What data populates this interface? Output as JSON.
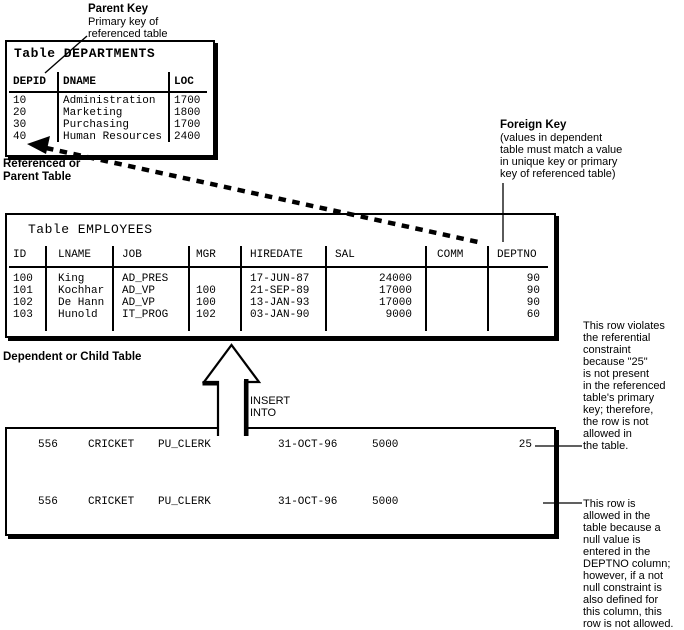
{
  "colors": {
    "ink": "#000000",
    "paper": "#ffffff"
  },
  "parent_key_note": {
    "title": "Parent Key",
    "line1": "Primary key of",
    "line2": "referenced table"
  },
  "referenced_label": {
    "line1": "Referenced or",
    "line2": "Parent Table"
  },
  "foreign_key_note": {
    "title": "Foreign Key",
    "line1": "(values in dependent",
    "line2": "table must match a value",
    "line3": "in unique key or primary",
    "line4": "key of referenced table)"
  },
  "dependent_label": "Dependent or Child Table",
  "insert_label": {
    "line1": "INSERT",
    "line2": "INTO"
  },
  "departments": {
    "title": "Table DEPARTMENTS",
    "cols": [
      "DEPID",
      "DNAME",
      "LOC"
    ],
    "rows": [
      [
        "10",
        "Administration",
        "1700"
      ],
      [
        "20",
        "Marketing",
        "1800"
      ],
      [
        "30",
        "Purchasing",
        "1700"
      ],
      [
        "40",
        "Human Resources",
        "2400"
      ]
    ]
  },
  "employees": {
    "title": "Table EMPLOYEES",
    "cols": [
      "ID",
      "LNAME",
      "JOB",
      "MGR",
      "HIREDATE",
      "SAL",
      "COMM",
      "DEPTNO"
    ],
    "rows": [
      [
        "100",
        "King",
        "AD_PRES",
        "",
        "17-JUN-87",
        "24000",
        "",
        "90"
      ],
      [
        "101",
        "Kochhar",
        "AD_VP",
        "100",
        "21-SEP-89",
        "17000",
        "",
        "90"
      ],
      [
        "102",
        "De Hann",
        "AD_VP",
        "100",
        "13-JAN-93",
        "17000",
        "",
        "90"
      ],
      [
        "103",
        "Hunold",
        "IT_PROG",
        "102",
        "03-JAN-90",
        "9000",
        "",
        "60"
      ]
    ]
  },
  "insert_rows": [
    [
      "556",
      "CRICKET",
      "PU_CLERK",
      "31-OCT-96",
      "5000",
      "25"
    ],
    [
      "556",
      "CRICKET",
      "PU_CLERK",
      "31-OCT-96",
      "5000",
      ""
    ]
  ],
  "violates_note": {
    "lines": [
      "This row violates",
      "the referential",
      "constraint",
      "because \"25\"",
      "is not present",
      "in the referenced",
      "table's primary",
      "key; therefore,",
      "the row is not",
      "allowed in",
      "the table."
    ]
  },
  "allowed_note": {
    "lines": [
      "This row is",
      "allowed in the",
      "table because a",
      "null value is",
      "entered in the",
      "DEPTNO column;",
      "however, if a not",
      "null constraint is",
      "also defined for",
      "this column, this",
      "row is not allowed."
    ]
  }
}
